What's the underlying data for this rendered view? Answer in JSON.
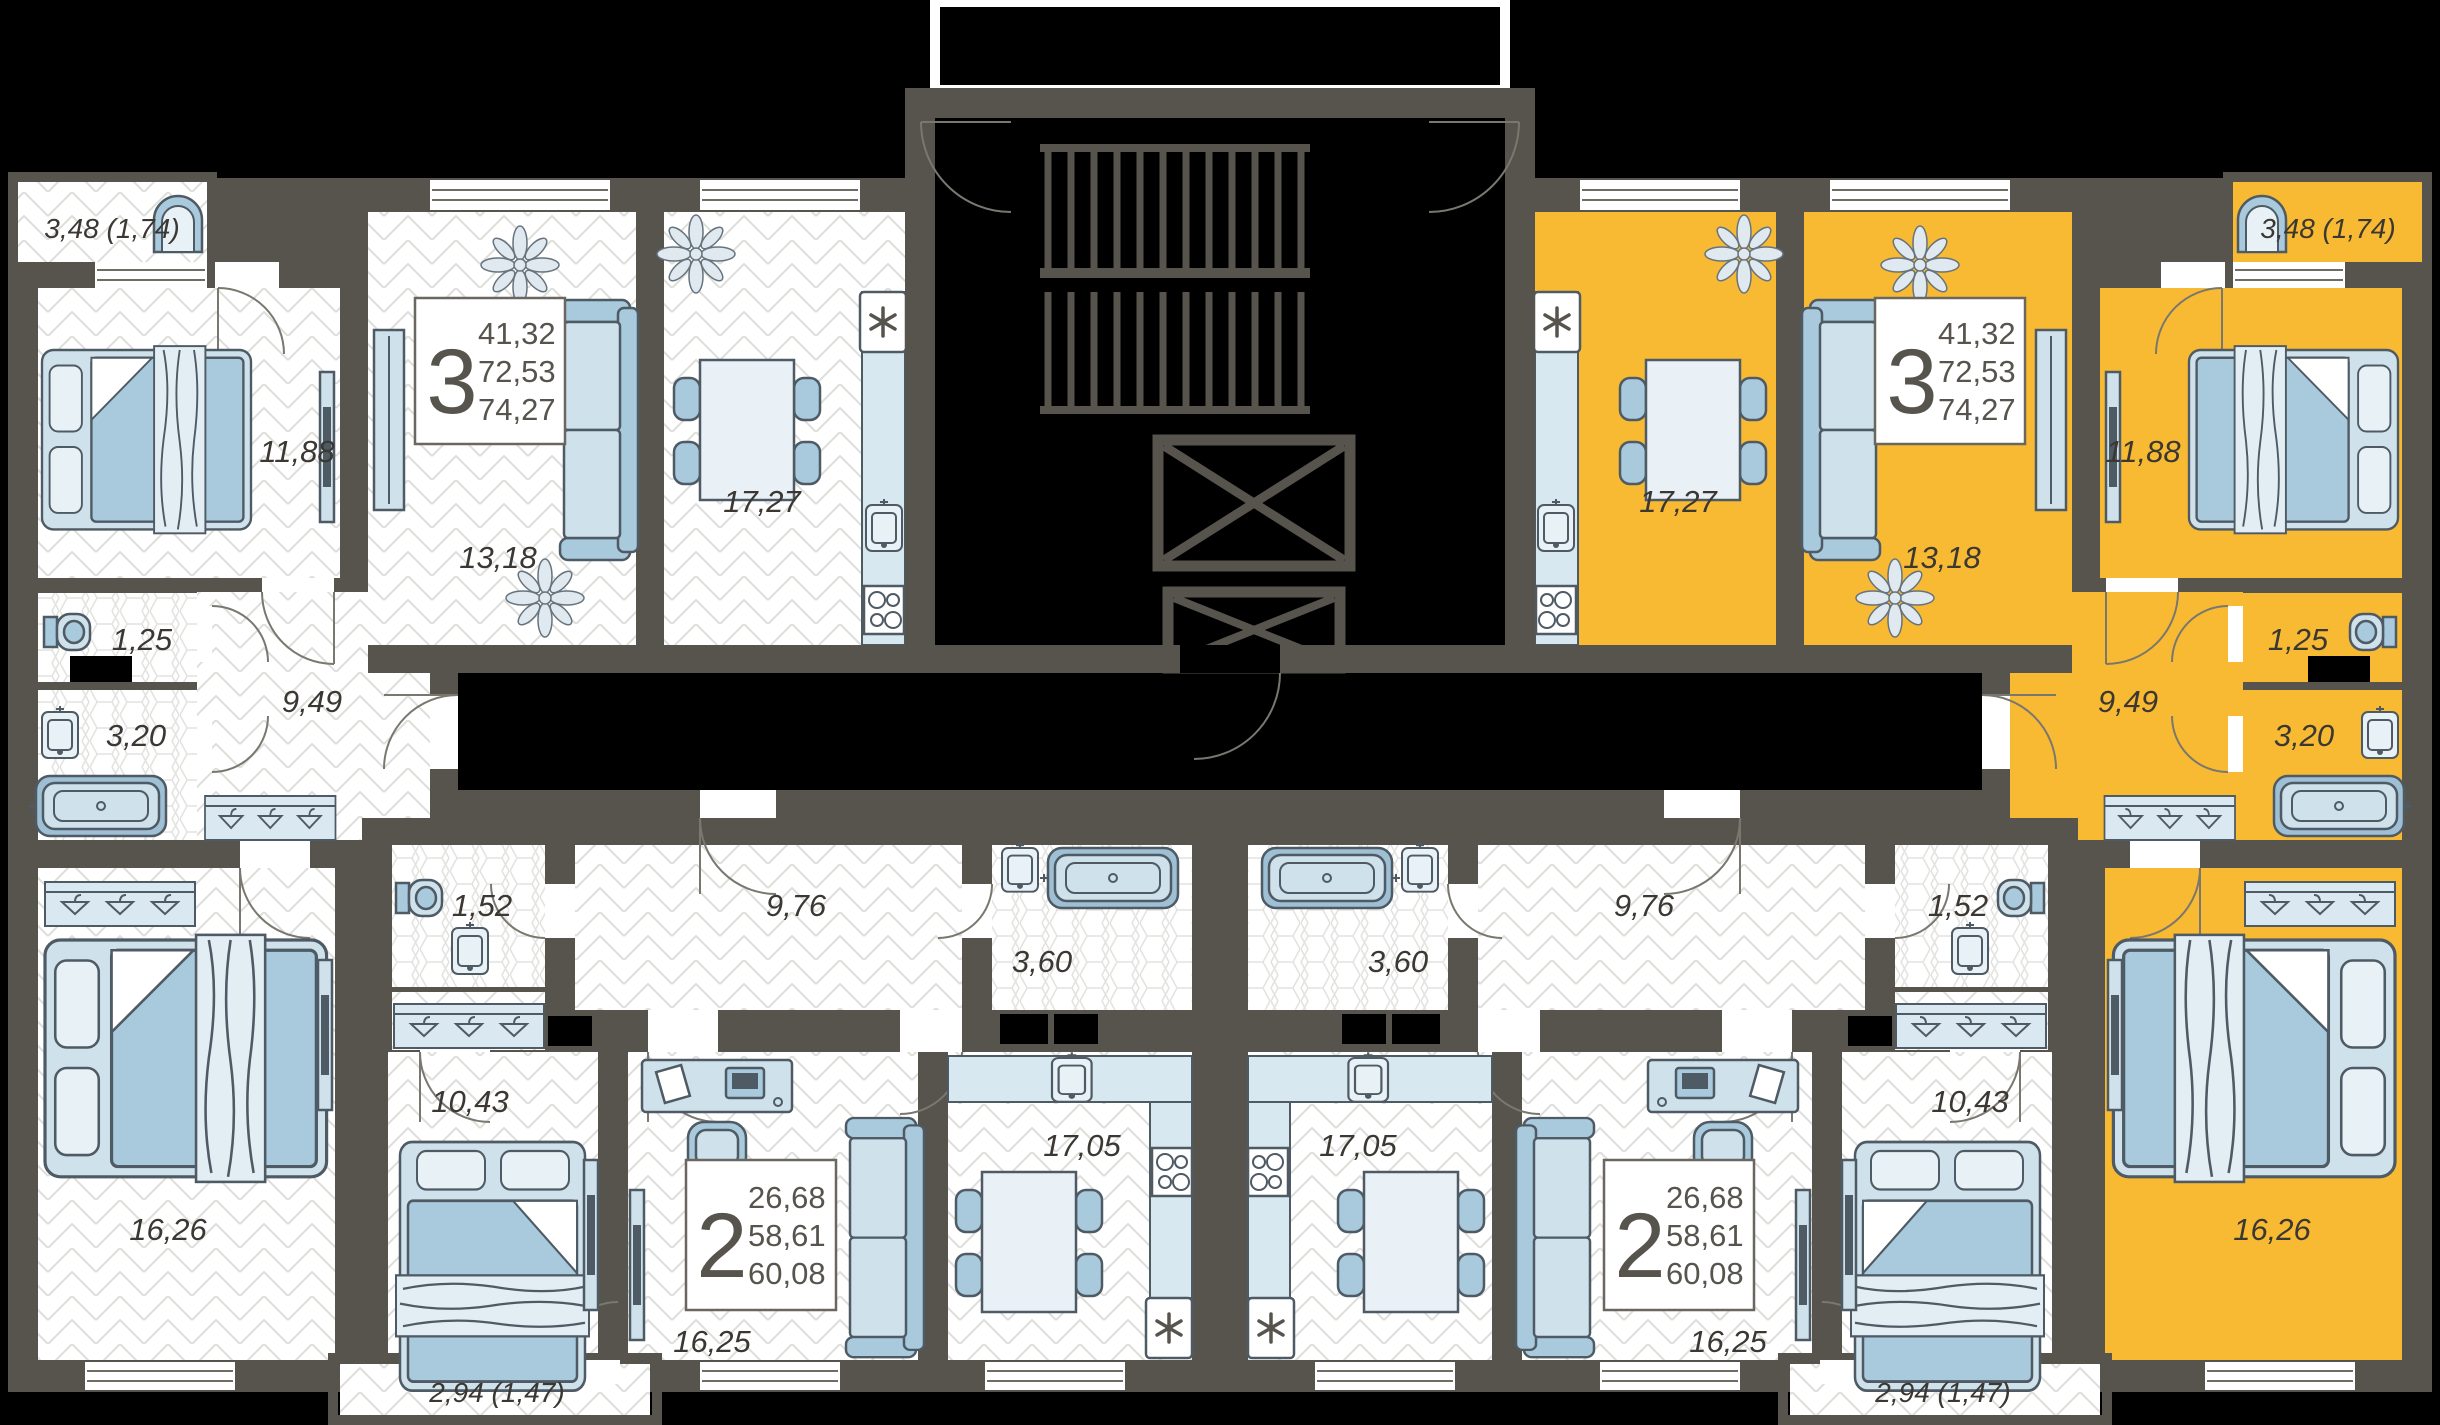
{
  "plan_title": "Residential floor plan with two 3-room and two 2-room apartments",
  "colors": {
    "highlight_apartment": "#F9BA33",
    "walls": "#57544E",
    "outside": "#000000",
    "floor": "#FFFFFF",
    "furniture": "#CFE2EC",
    "text": "#3B3833"
  },
  "icons": {
    "fridge-icon": "six-spoke asterisk",
    "stairs-icon": "double flight treads",
    "elevator-icon": "crossed box"
  },
  "apartments": {
    "top_left_3room": {
      "type": "3",
      "highlighted": false,
      "areas": {
        "a1": "41,32",
        "a2": "72,53",
        "a3": "74,27"
      },
      "rooms": {
        "balcony": "3,48 (1,74)",
        "bedroom": "11,88",
        "living": "13,18",
        "kitchen": "17,27",
        "wc": "1,25",
        "bathroom": "3,20",
        "hallway": "9,49",
        "bedroom2": "16,26"
      }
    },
    "top_right_3room": {
      "type": "3",
      "highlighted": true,
      "areas": {
        "a1": "41,32",
        "a2": "72,53",
        "a3": "74,27"
      },
      "rooms": {
        "balcony": "3,48 (1,74)",
        "bedroom": "11,88",
        "living": "13,18",
        "kitchen": "17,27",
        "wc": "1,25",
        "bathroom": "3,20",
        "hallway": "9,49",
        "bedroom2": "16,26"
      }
    },
    "bottom_left_2room": {
      "type": "2",
      "highlighted": false,
      "areas": {
        "a1": "26,68",
        "a2": "58,61",
        "a3": "60,08"
      },
      "rooms": {
        "wc": "1,52",
        "hallway": "9,76",
        "bathroom": "3,60",
        "bedroom": "10,43",
        "living": "16,25",
        "kitchen": "17,05",
        "balcony": "2,94 (1,47)"
      }
    },
    "bottom_right_2room": {
      "type": "2",
      "highlighted": false,
      "areas": {
        "a1": "26,68",
        "a2": "58,61",
        "a3": "60,08"
      },
      "rooms": {
        "wc": "1,52",
        "hallway": "9,76",
        "bathroom": "3,60",
        "bedroom": "10,43",
        "living": "16,25",
        "kitchen": "17,05",
        "balcony": "2,94 (1,47)"
      }
    }
  }
}
